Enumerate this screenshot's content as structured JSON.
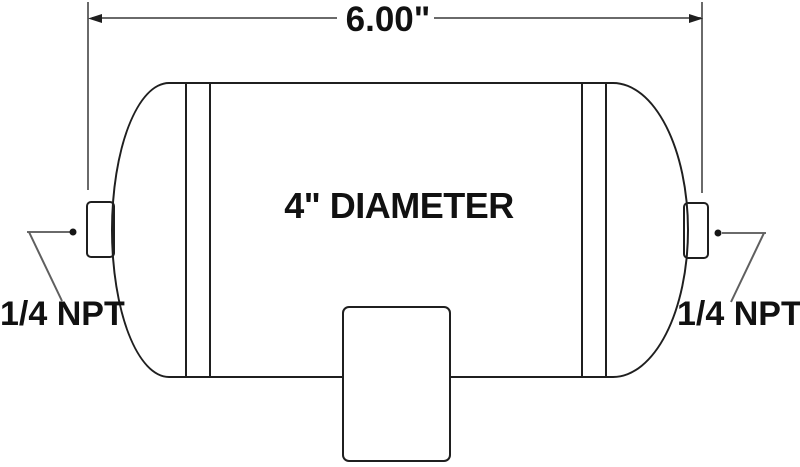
{
  "colors": {
    "background": "#ffffff",
    "object_line": "#1f1f1f",
    "construction_line": "#6a6a6a",
    "text": "#111111"
  },
  "labels": {
    "length_dimension": "6.00\"",
    "diameter": "4\" DIAMETER",
    "left_port": "1/4 NPT",
    "right_port": "1/4 NPT"
  }
}
